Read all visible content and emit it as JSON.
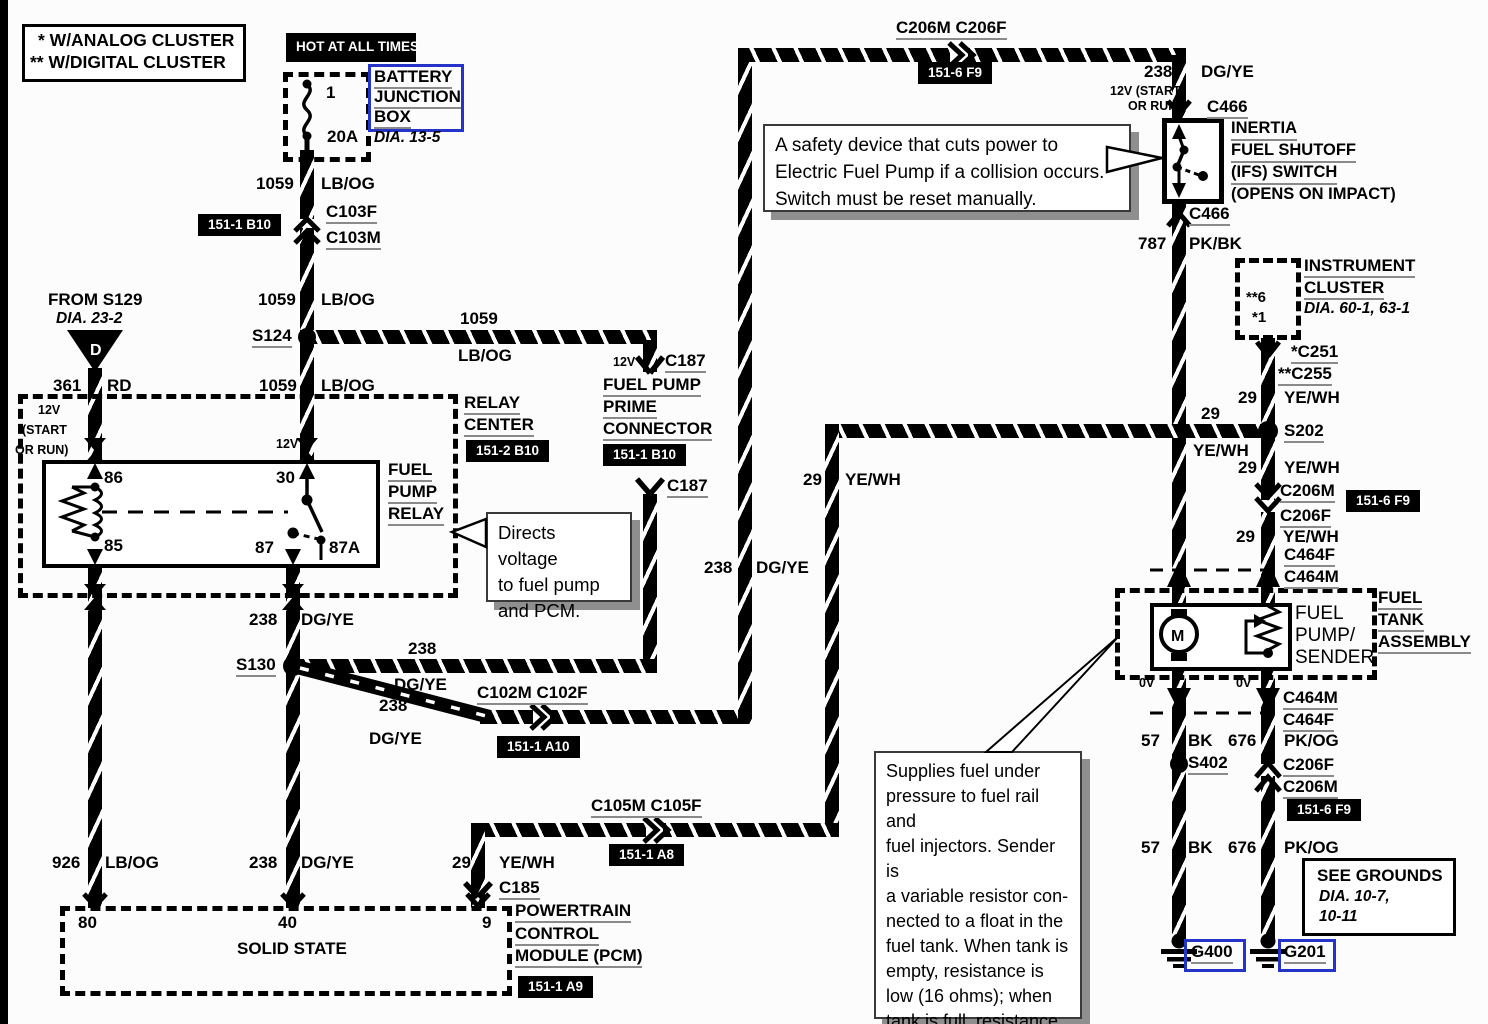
{
  "legend": {
    "analog": "* W/ANALOG CLUSTER",
    "digital": "** W/DIGITAL CLUSTER"
  },
  "battery": {
    "hot": "HOT AT ALL TIMES",
    "fuse_no": "1",
    "fuse_amp": "20A",
    "bjb1": "BATTERY",
    "bjb2": "JUNCTION",
    "bjb3": "BOX",
    "dia": "DIA. 13-5"
  },
  "refs": {
    "b10": "151-1 B10",
    "b10_relay": "151-2 B10",
    "f9": "151-6 F9",
    "a10": "151-1 A10",
    "a8": "151-1 A8",
    "a9": "151-1 A9"
  },
  "w": {
    "n1059": "1059",
    "lbog": "LB/OG",
    "n361": "361",
    "rd": "RD",
    "n238": "238",
    "dgye": "DG/YE",
    "n29": "29",
    "yewh": "YE/WH",
    "n787": "787",
    "pkbk": "PK/BK",
    "n926": "926",
    "n57": "57",
    "bk": "BK",
    "n676": "676",
    "pkog": "PK/OG",
    "v12": "12V",
    "v0": "0V",
    "start": "(START",
    "orrun": "OR RUN)",
    "start12": "12V (START"
  },
  "conn": {
    "c103f": "C103F",
    "c103m": "C103M",
    "s124": "S124",
    "c187": "C187",
    "s130": "S130",
    "c102": "C102M C102F",
    "c105": "C105M C105F",
    "c185": "C185",
    "c206top": "C206M C206F",
    "c466": "C466",
    "c251": "*C251",
    "c255": "**C255",
    "s202": "S202",
    "c206m": "C206M",
    "c206f": "C206F",
    "c464f": "C464F",
    "c464m": "C464M",
    "s402": "S402",
    "g400": "G400",
    "g201": "G201"
  },
  "pins": {
    "p86": "86",
    "p30": "30",
    "p85": "85",
    "p87": "87",
    "p87a": "87A",
    "p80": "80",
    "p40": "40",
    "p9": "9"
  },
  "s129": {
    "t": "FROM S129",
    "dia": "DIA. 23-2",
    "d": "D"
  },
  "relay_center": {
    "l1": "RELAY",
    "l2": "CENTER"
  },
  "prime": {
    "l1": "FUEL PUMP",
    "l2": "PRIME",
    "l3": "CONNECTOR"
  },
  "relay": {
    "l1": "FUEL",
    "l2": "PUMP",
    "l3": "RELAY"
  },
  "pcm": {
    "l1": "POWERTRAIN",
    "l2": "CONTROL",
    "l3": "MODULE (PCM)",
    "solid": "SOLID STATE"
  },
  "ifs": {
    "l1": "INERTIA",
    "l2": "FUEL SHUTOFF",
    "l3": "(IFS) SWITCH",
    "l4": "(OPENS ON IMPACT)"
  },
  "cluster": {
    "l1": "INSTRUMENT",
    "l2": "CLUSTER",
    "dia": "DIA. 60-1, 63-1",
    "pin6": "**6",
    "pin1": "*1"
  },
  "tank": {
    "l1": "FUEL",
    "l2": "TANK",
    "l3": "ASSEMBLY"
  },
  "pump": {
    "l1": "FUEL",
    "l2": "PUMP/",
    "l3": "SENDER",
    "m": "M"
  },
  "grounds_note": {
    "l1": "SEE GROUNDS",
    "l2": "DIA. 10-7,",
    "l3": "10-11"
  },
  "callouts": {
    "safety": [
      "A safety device that cuts power to",
      "Electric Fuel Pump if a collision occurs.",
      "Switch must be reset manually."
    ],
    "directs": [
      "Directs voltage",
      "to fuel pump",
      "and PCM."
    ],
    "supplies": [
      "Supplies fuel under",
      "pressure to fuel rail and",
      "fuel injectors. Sender is",
      "a variable resistor con-",
      "nected to a float in the",
      "fuel tank. When tank is",
      "empty, resistance is",
      "low (16 ohms); when",
      "tank is full, resistance",
      "is high (160 ohms)."
    ]
  }
}
